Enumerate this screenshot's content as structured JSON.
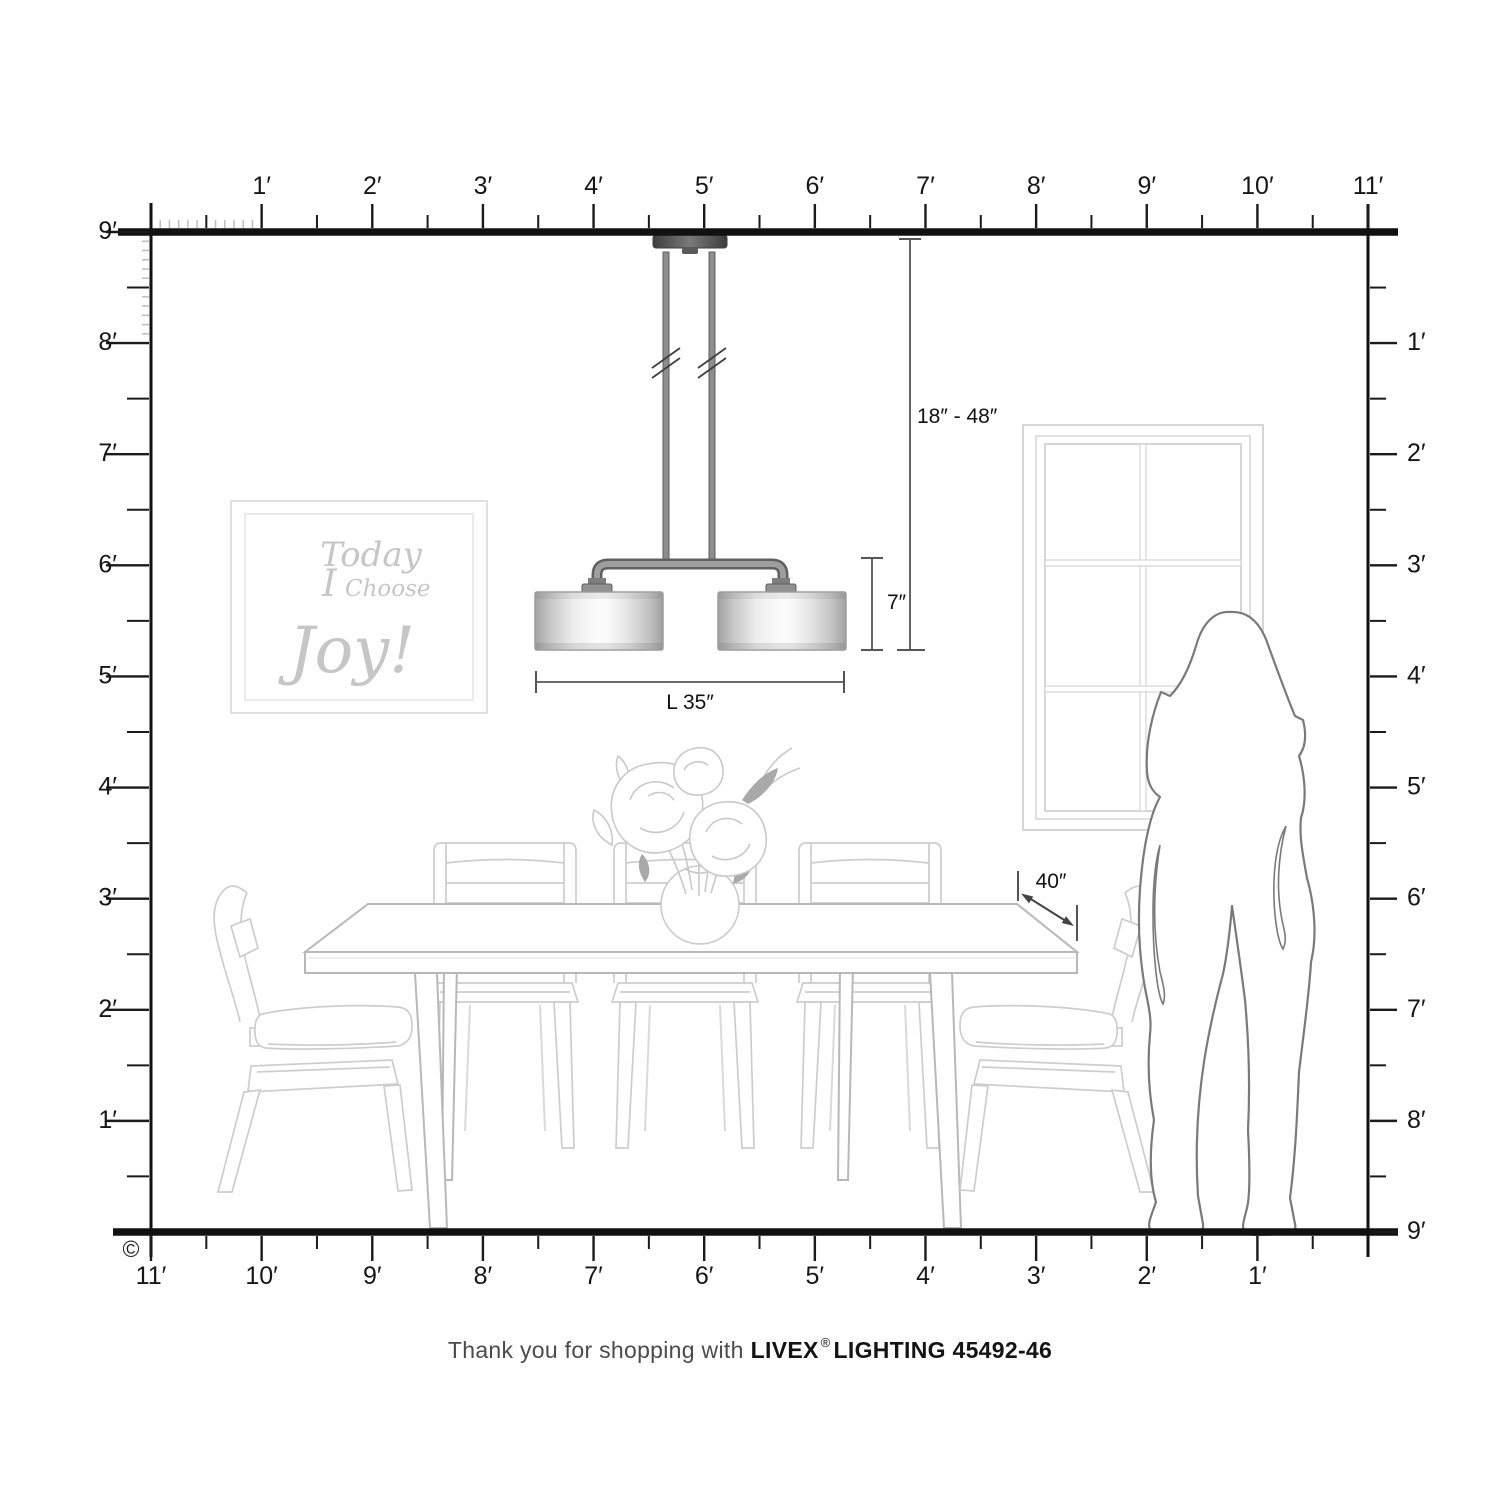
{
  "rulers": {
    "top": [
      "1′",
      "2′",
      "3′",
      "4′",
      "5′",
      "6′",
      "7′",
      "8′",
      "9′",
      "10′",
      "11′"
    ],
    "left": [
      "9′",
      "8′",
      "7′",
      "6′",
      "5′",
      "4′",
      "3′",
      "2′",
      "1′"
    ],
    "right": [
      "1′",
      "2′",
      "3′",
      "4′",
      "5′",
      "6′",
      "7′",
      "8′",
      "9′"
    ],
    "bottom": [
      "11′",
      "10′",
      "9′",
      "8′",
      "7′",
      "6′",
      "5′",
      "4′",
      "3′",
      "2′",
      "1′"
    ]
  },
  "dimensions": {
    "hang_range": "18″ - 48″",
    "fixture_height": "7″",
    "fixture_length": "L 35″",
    "clearance": "40″"
  },
  "wall_art": {
    "line1": "Today",
    "line2_word1": "I",
    "line2_word2": "Choose",
    "line3": "Joy!"
  },
  "caption": {
    "prefix": "Thank you for shopping with",
    "brand": "LIVEX",
    "registered": "®",
    "product": "LIGHTING 45492-46"
  },
  "copyright": "©",
  "colors": {
    "ruler_black": "#1a1a1a",
    "furniture_gray": "#cdcdcd",
    "art_gray": "#c6c6c6",
    "silhouette_gray": "#7a7a7a",
    "metal_gray": "#8d8d8d"
  }
}
